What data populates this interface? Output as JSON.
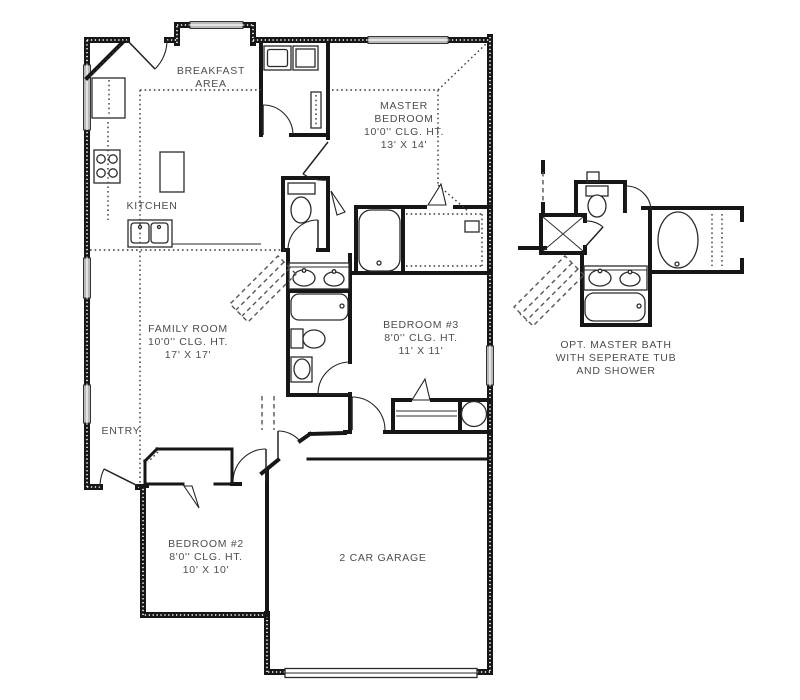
{
  "plan_title": "Single story floor plan",
  "rooms": {
    "breakfast_area": {
      "lines": [
        "BREAKFAST",
        "AREA"
      ]
    },
    "kitchen": {
      "lines": [
        "KITCHEN"
      ]
    },
    "master_bedroom": {
      "lines": [
        "MASTER",
        "BEDROOM",
        "10'0'' CLG. HT.",
        "13' X 14'"
      ]
    },
    "family_room": {
      "lines": [
        "FAMILY ROOM",
        "10'0'' CLG. HT.",
        "17' X 17'"
      ]
    },
    "bedroom_3": {
      "lines": [
        "BEDROOM #3",
        "8'0'' CLG. HT.",
        "11' X 11'"
      ]
    },
    "entry": {
      "lines": [
        "ENTRY"
      ]
    },
    "bedroom_2": {
      "lines": [
        "BEDROOM #2",
        "8'0'' CLG. HT.",
        "10' X 10'"
      ]
    },
    "garage": {
      "lines": [
        "2 CAR GARAGE"
      ]
    },
    "opt_master_bath": {
      "lines": [
        "OPT. MASTER BATH",
        "WITH SEPERATE TUB",
        "AND SHOWER"
      ]
    }
  },
  "colors": {
    "wall": "#161616",
    "label_text": "#4d4d4d",
    "window_fill": "#b9b9b9",
    "background": "#ffffff"
  }
}
